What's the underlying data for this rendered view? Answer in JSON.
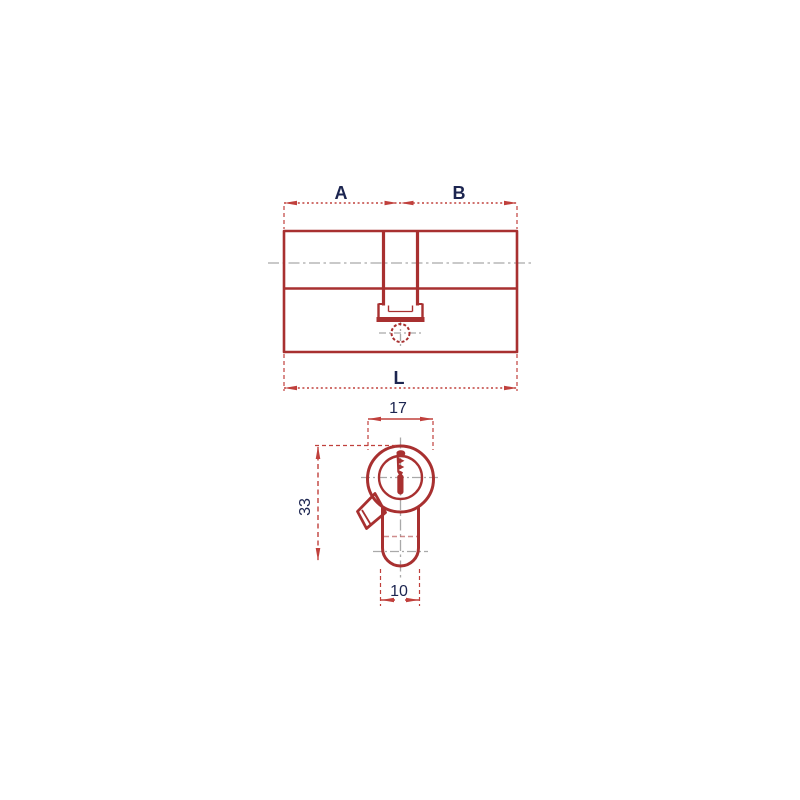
{
  "colors": {
    "outline": "#a83030",
    "dimension": "#c0403c",
    "centerline": "#a9a9a9",
    "label": "#1c2550",
    "background": "#ffffff"
  },
  "top_view": {
    "name": "cylinder side view",
    "dimensions": {
      "left_segment": "A",
      "right_segment": "B",
      "total_length": "L"
    }
  },
  "front_view": {
    "name": "cylinder profile view",
    "dimensions": {
      "width": "17",
      "height": "33",
      "body_width": "10"
    }
  }
}
